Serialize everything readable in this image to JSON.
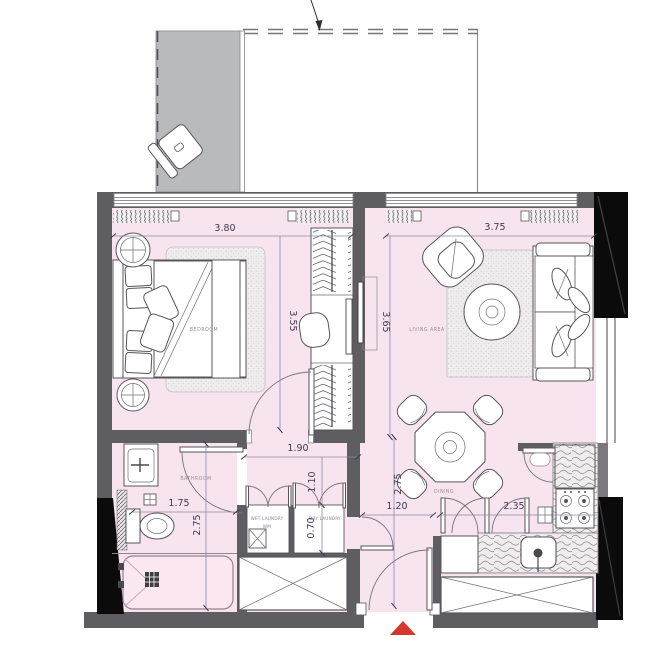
{
  "floorplan": {
    "bedroom": {
      "label": "BEDROOM",
      "width": "3.80",
      "depth": "3.55"
    },
    "living": {
      "label": "LIVING AREA",
      "width": "3.75",
      "depth": "3.65"
    },
    "dining": {
      "label": "DINING",
      "depth": "2.75"
    },
    "bathroom": {
      "label": "BATHROOM",
      "width": "1.75",
      "depth": "2.75"
    },
    "hall": {
      "width": "1.90",
      "depth": "1.10"
    },
    "laundry": {
      "wet": "WET LAUNDRY",
      "wet_sub": "WM",
      "dry": "DRY LAUNDRY",
      "depth": "0.70"
    },
    "entry": {
      "width": "1.20"
    },
    "kitchen": {
      "width": "2.35"
    },
    "colors": {
      "floor": "#F8E4EF",
      "wall": "#5E5D61",
      "balcony": "#B9BABC",
      "column": "#0B0B0B",
      "dimension_text": "#3D3D55",
      "room_label": "#9A8F9B",
      "entry_marker": "#D2382C"
    }
  }
}
